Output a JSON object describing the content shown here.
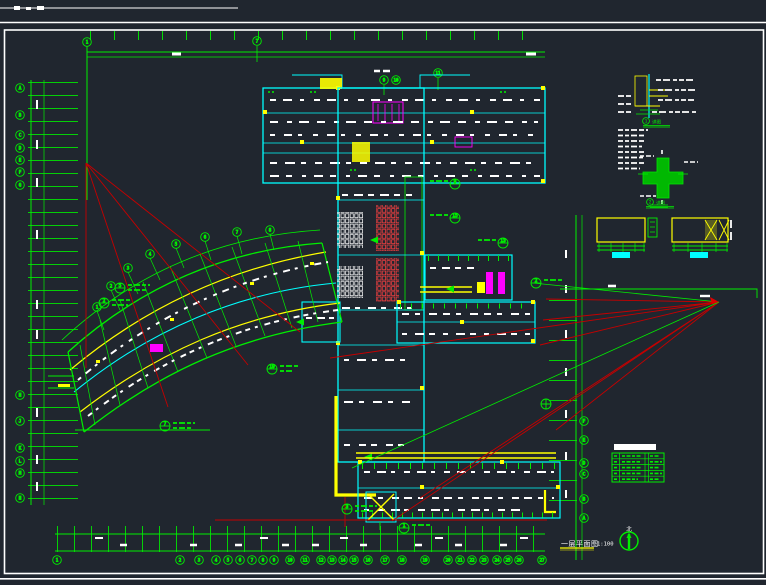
{
  "drawing": {
    "title": "一层平面图",
    "scale": "1:100",
    "north_label": "北",
    "detail_titles": {
      "a": "详图",
      "b": "详图"
    },
    "colors": {
      "background": "#20262f",
      "grid_green": "#00ef00",
      "wall_cyan": "#00ffff",
      "axis_red": "#e00000",
      "highlight_yellow": "#ffff00",
      "fixture_magenta": "#ff00ff",
      "annotation_white": "#ffffff"
    },
    "axes": {
      "top": [
        "1",
        "7",
        "9",
        "10",
        "11"
      ],
      "bottom": [
        "1",
        "2",
        "3",
        "4",
        "5",
        "6",
        "7",
        "8",
        "9",
        "10",
        "11",
        "12",
        "13",
        "14",
        "15",
        "16",
        "17",
        "18",
        "19",
        "20",
        "21",
        "22",
        "23",
        "24",
        "25",
        "26",
        "27"
      ],
      "left_upper": [
        "A",
        "B",
        "C",
        "D",
        "E",
        "F",
        "G"
      ],
      "left_lower": [
        "H",
        "J",
        "K",
        "L",
        "M",
        "N"
      ],
      "right": [
        "F",
        "E",
        "D",
        "C",
        "B",
        "A"
      ],
      "fan": [
        "1",
        "2",
        "3",
        "4",
        "5",
        "6",
        "7",
        "8"
      ]
    },
    "callouts": {
      "fan_a": "5",
      "fan_b": "2",
      "fan_c": "19",
      "fan_d": "7",
      "spine_a": "9",
      "spine_b": "15",
      "spine_c": "13",
      "wing_a": "2",
      "entry_a": "3",
      "entry_b": "1",
      "detail_a": "1",
      "detail_b": "2"
    }
  }
}
